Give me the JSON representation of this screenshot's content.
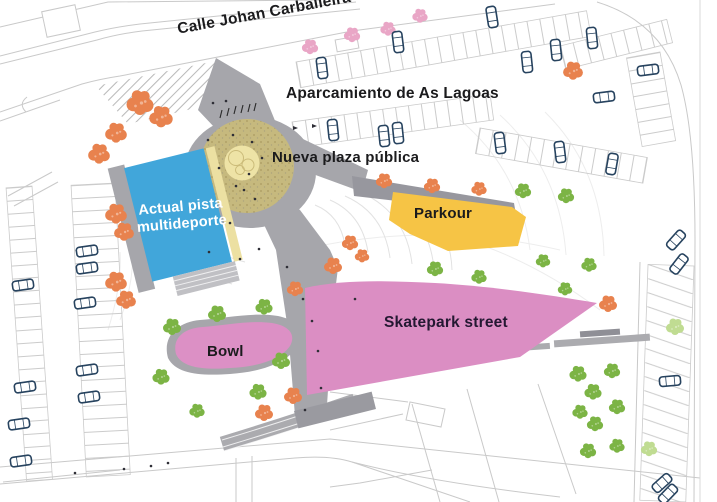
{
  "labels": {
    "street": "Calle Johan Carballeira",
    "parking": "Aparcamiento de As Lagoas",
    "plaza": "Nueva plaza pública",
    "multisport": "Actual pista multideporte",
    "parkour": "Parkour",
    "skatepark": "Skatepark street",
    "bowl": "Bowl"
  },
  "colors": {
    "multisport_blue": "#41a6da",
    "parkour_yellow": "#f6c445",
    "skatepark_pink": "#db8ec3",
    "bowl_pink": "#dc90c5",
    "bowl_border_gray": "#a6a6ab",
    "plaza_tan": "#c6b97e",
    "plaza_inner_yellow": "#eee3a6",
    "path_gray": "#a6a6ab",
    "path_gray_dark": "#97979e",
    "tree_orange": "#e8824e",
    "tree_green": "#7cb445",
    "tree_light_green": "#c0dc92",
    "tree_pink": "#e9a6c6",
    "car_outline_navy": "#27435f"
  }
}
